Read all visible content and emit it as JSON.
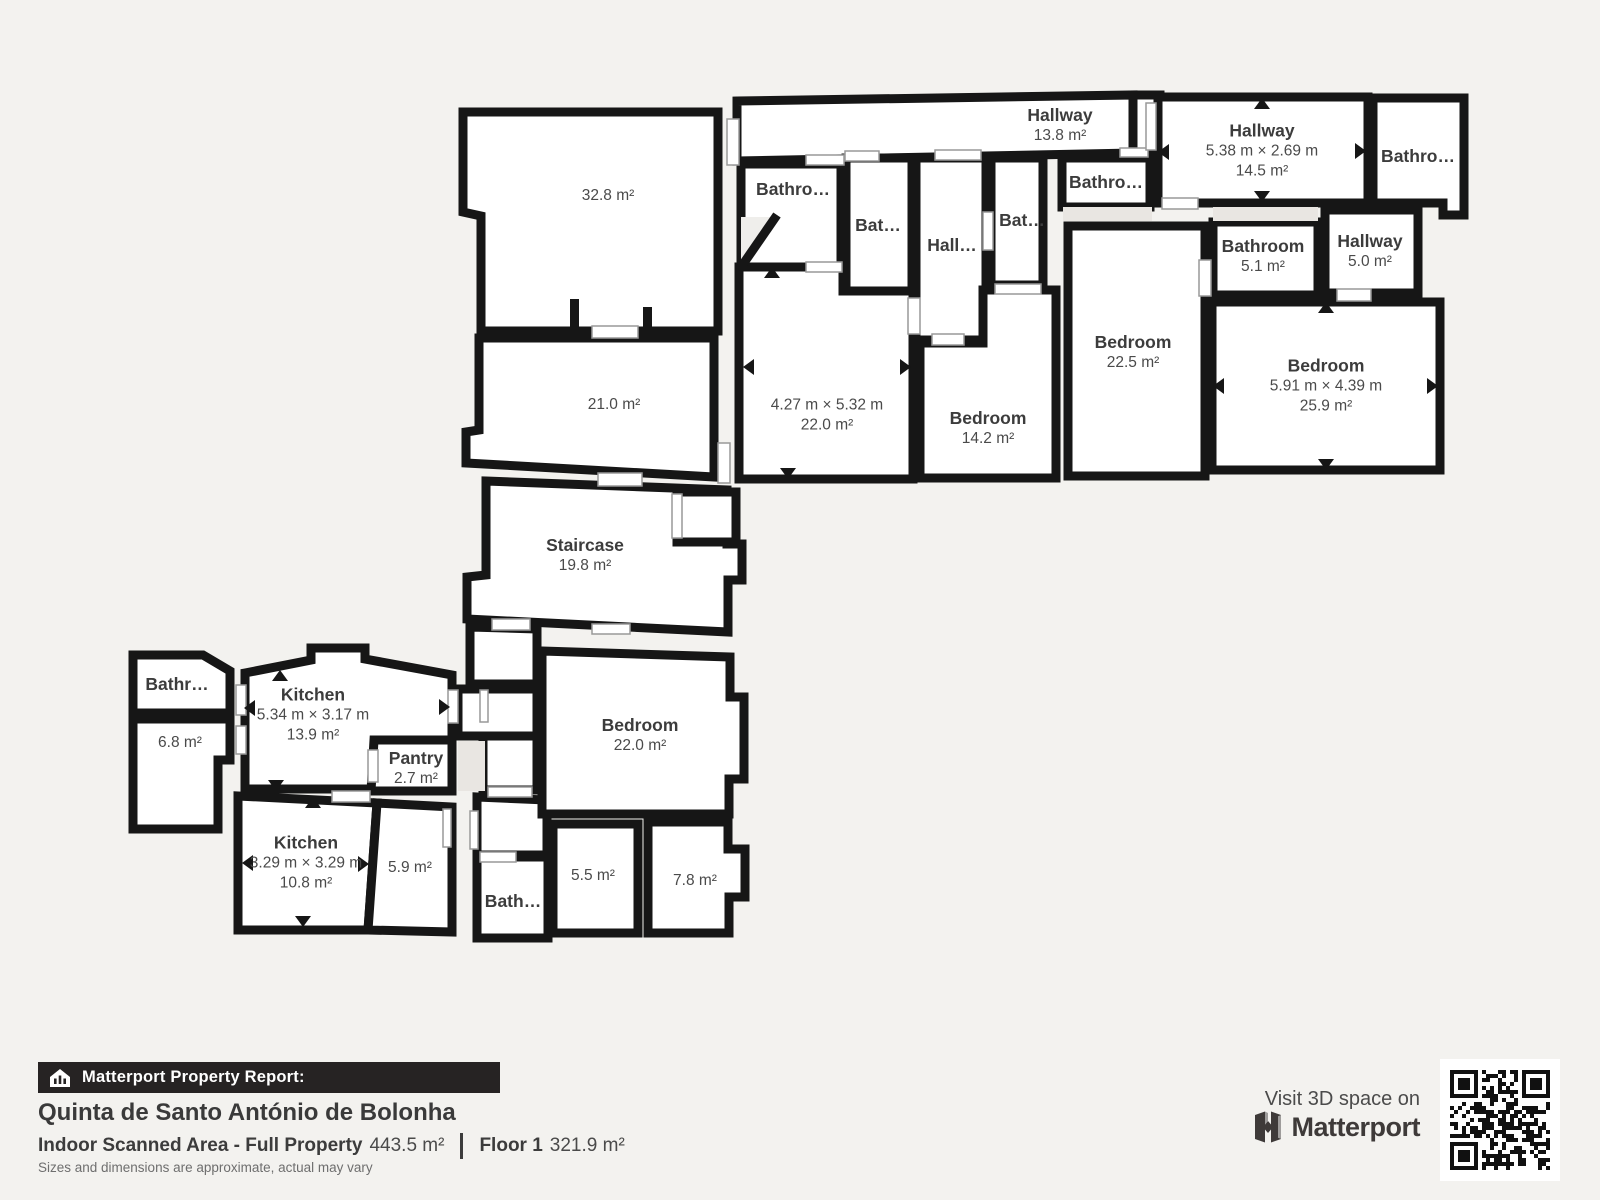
{
  "page": {
    "background": "#f3f2ef"
  },
  "floorplan": {
    "wall_color": "#161616",
    "room_fill": "#ffffff",
    "label_color": "#3d3d3d",
    "rooms": [
      {
        "id": "room-32-8",
        "area": "32.8 m²",
        "cx": 608,
        "cy": 196
      },
      {
        "id": "room-21-0",
        "area": "21.0 m²",
        "cx": 614,
        "cy": 405
      },
      {
        "id": "staircase",
        "name": "Staircase",
        "area": "19.8 m²",
        "cx": 585,
        "cy": 555
      },
      {
        "id": "hallway-13-8",
        "name": "Hallway",
        "area": "13.8 m²",
        "cx": 1060,
        "cy": 125
      },
      {
        "id": "bathroom-top-a",
        "name": "Bathro…",
        "cx": 793,
        "cy": 189
      },
      {
        "id": "bathroom-top-b",
        "name": "Bat…",
        "cx": 878,
        "cy": 225
      },
      {
        "id": "hallway-mid",
        "name": "Hall…",
        "cx": 952,
        "cy": 245
      },
      {
        "id": "bathroom-top-c",
        "name": "Bat…",
        "cx": 1022,
        "cy": 220
      },
      {
        "id": "bathroom-top-d",
        "name": "Bathro…",
        "cx": 1106,
        "cy": 182
      },
      {
        "id": "hallway-14-5",
        "name": "Hallway",
        "dims": "5.38 m × 2.69 m",
        "area": "14.5 m²",
        "cx": 1262,
        "cy": 150
      },
      {
        "id": "bathroom-top-right",
        "name": "Bathro…",
        "cx": 1418,
        "cy": 156
      },
      {
        "id": "bathroom-5-1",
        "name": "Bathroom",
        "area": "5.1 m²",
        "cx": 1263,
        "cy": 256
      },
      {
        "id": "hallway-5-0",
        "name": "Hallway",
        "area": "5.0 m²",
        "cx": 1370,
        "cy": 251
      },
      {
        "id": "room-22-0-upper",
        "dims": "4.27 m × 5.32 m",
        "area": "22.0 m²",
        "cx": 827,
        "cy": 415
      },
      {
        "id": "bedroom-14-2",
        "name": "Bedroom",
        "area": "14.2 m²",
        "cx": 988,
        "cy": 428
      },
      {
        "id": "bedroom-22-5",
        "name": "Bedroom",
        "area": "22.5 m²",
        "cx": 1133,
        "cy": 352
      },
      {
        "id": "bedroom-25-9",
        "name": "Bedroom",
        "dims": "5.91 m × 4.39 m",
        "area": "25.9 m²",
        "cx": 1326,
        "cy": 385
      },
      {
        "id": "bathroom-left",
        "name": "Bathr…",
        "cx": 177,
        "cy": 684
      },
      {
        "id": "room-6-8",
        "area": "6.8 m²",
        "cx": 180,
        "cy": 743
      },
      {
        "id": "kitchen-13-9",
        "name": "Kitchen",
        "dims": "5.34 m × 3.17 m",
        "area": "13.9 m²",
        "cx": 313,
        "cy": 714
      },
      {
        "id": "pantry",
        "name": "Pantry",
        "area": "2.7 m²",
        "cx": 416,
        "cy": 768
      },
      {
        "id": "kitchen-10-8",
        "name": "Kitchen",
        "dims": "3.29 m × 3.29 m",
        "area": "10.8 m²",
        "cx": 306,
        "cy": 862
      },
      {
        "id": "room-5-9",
        "area": "5.9 m²",
        "cx": 410,
        "cy": 868
      },
      {
        "id": "bathroom-small",
        "name": "Bath…",
        "cx": 513,
        "cy": 901
      },
      {
        "id": "room-5-5",
        "area": "5.5 m²",
        "cx": 593,
        "cy": 876
      },
      {
        "id": "room-7-8",
        "area": "7.8 m²",
        "cx": 695,
        "cy": 881
      },
      {
        "id": "bedroom-22-0",
        "name": "Bedroom",
        "area": "22.0 m²",
        "cx": 640,
        "cy": 735
      }
    ]
  },
  "footer": {
    "report_label": "Matterport Property Report:",
    "property_name": "Quinta de Santo António de Bolonha",
    "scanned_area_label": "Indoor Scanned Area - Full Property",
    "scanned_area_value": "443.5 m²",
    "floor_label": "Floor 1",
    "floor_value": "321.9 m²",
    "disclaimer": "Sizes and dimensions are approximate, actual may vary",
    "visit_label": "Visit 3D space on",
    "brand": "Matterport"
  }
}
